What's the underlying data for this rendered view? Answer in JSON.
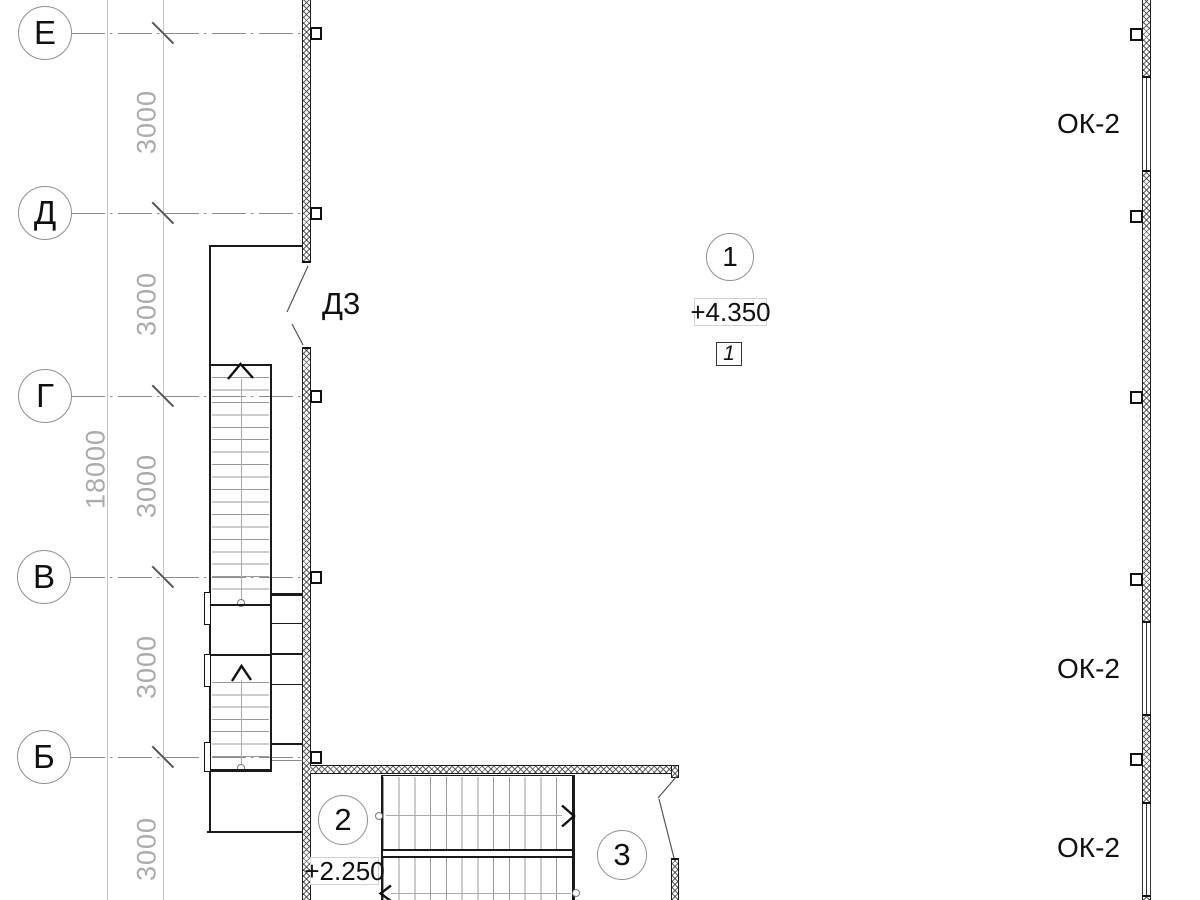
{
  "plan": {
    "grid": {
      "rows": [
        {
          "label": "Е"
        },
        {
          "label": "Д"
        },
        {
          "label": "Г"
        },
        {
          "label": "В"
        },
        {
          "label": "Б"
        }
      ]
    },
    "dimensions": {
      "overall": "18000",
      "bays": [
        "3000",
        "3000",
        "3000",
        "3000",
        "3000"
      ]
    },
    "tags": {
      "door": "Д3",
      "windows": [
        "ОК-2",
        "ОК-2",
        "ОК-2"
      ]
    },
    "markers": {
      "circles": [
        {
          "label": "1"
        },
        {
          "label": "2"
        },
        {
          "label": "3"
        }
      ],
      "elevations": [
        {
          "value": "+4.350"
        },
        {
          "value": "+2.250"
        }
      ],
      "floor_box": "1"
    }
  }
}
